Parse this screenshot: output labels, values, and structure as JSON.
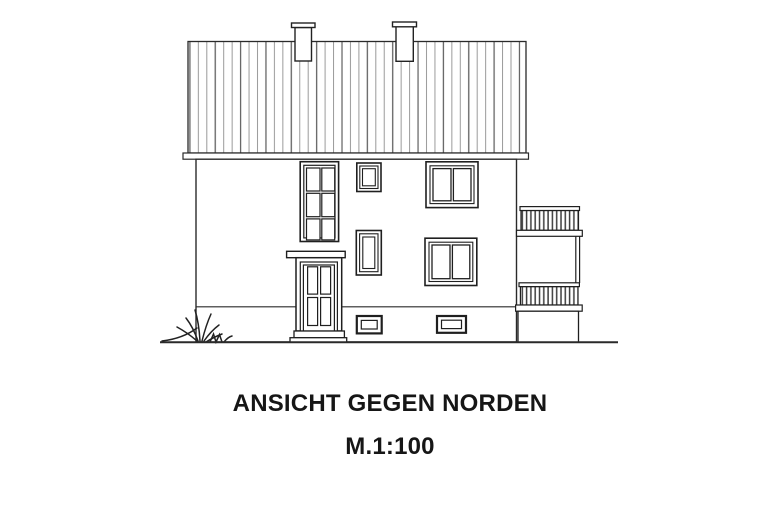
{
  "caption": {
    "title": "ANSICHT GEGEN NORDEN",
    "scale": "M.1:100"
  },
  "drawing": {
    "type": "architectural-elevation",
    "background_color": "#ffffff",
    "line_color": "#1f1f1f",
    "roof_hatch_light_color": "#9a9a9a",
    "roof_hatch_dark_color": "#636363",
    "railing_bar_color": "#3d3d3d",
    "elements": [
      "roof",
      "chimney-left",
      "chimney-right",
      "eave-fascia",
      "facade-wall",
      "plinth-line",
      "stair-window",
      "upper-small-window",
      "mid-small-window",
      "upper-right-window",
      "lower-right-window",
      "entrance-canopy",
      "entrance-door",
      "entrance-steps",
      "basement-window-left",
      "basement-window-right",
      "balcony-upper-railing",
      "balcony-lower-railing",
      "balcony-base",
      "ground-line",
      "grass-tuft"
    ]
  }
}
